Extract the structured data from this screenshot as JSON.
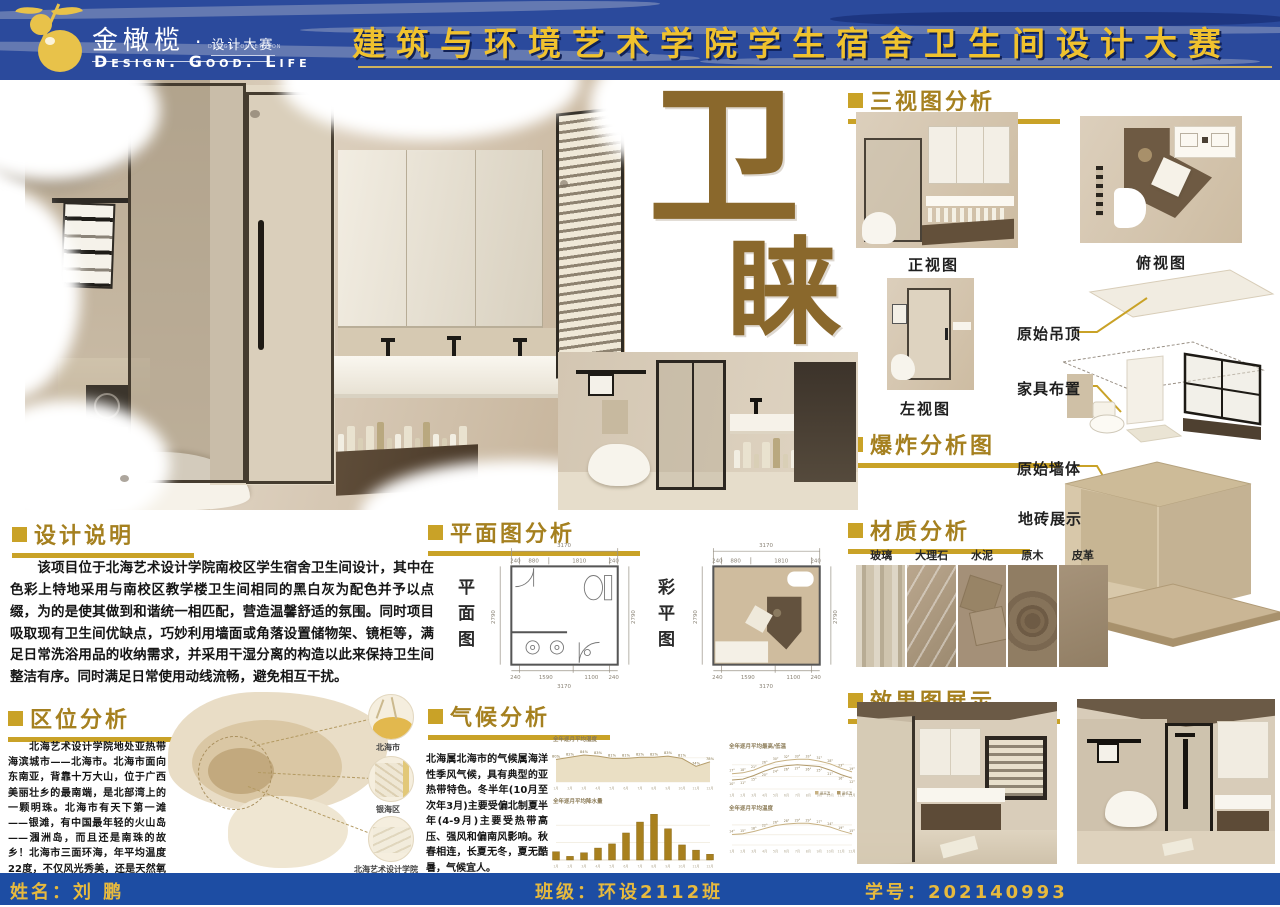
{
  "banner": {
    "brand": "金橄榄",
    "brand_dot": "·",
    "brand_sub": "设计大赛",
    "brand_sub_en": "DESIGN COMPETITION",
    "tagline": "Design. Good. Life",
    "title": "建筑与环境艺术学院学生宿舍卫生间设计大赛"
  },
  "hero": {
    "big_char_top": "卫",
    "big_char_bottom": "睐"
  },
  "three_view": {
    "title": "三视图分析",
    "front_label": "正视图",
    "top_label": "俯视图",
    "left_label": "左视图"
  },
  "explosion": {
    "title": "爆炸分析图",
    "labels": {
      "ceiling": "原始吊顶",
      "furniture": "家具布置",
      "walls": "原始墙体",
      "tiles": "地砖展示"
    }
  },
  "materials": {
    "title": "材质分析",
    "items": [
      "玻璃",
      "大理石",
      "水泥",
      "原木",
      "皮革"
    ]
  },
  "renders": {
    "title": "效果图展示"
  },
  "design_note": {
    "title": "设计说明",
    "body": "　　该项目位于北海艺术设计学院南校区学生宿舍卫生间设计，其中在色彩上特地采用与南校区教学楼卫生间相同的黑白灰为配色并予以点缀，为的是使其做到和谐统一相匹配，营造温馨舒适的氛围。同时项目吸取现有卫生间优缺点，巧妙利用墙面或角落设置储物架、镜柜等，满足日常洗浴用品的收纳需求，并采用干湿分离的构造以此来保持卫生间整洁有序。同时满足日常使用动线流畅，避免相互干扰。"
  },
  "location": {
    "title": "区位分析",
    "body": "　　北海艺术设计学院地处亚热带海滨城市——北海市。北海市面向东南亚，背靠十万大山，位于广西美丽壮乡的最南端，是北部湾上的一颗明珠。北海市有天下第一滩——银滩，有中国最年轻的火山岛——涠洲岛，而且还是南珠的故乡！北海市三面环海，年平均温度22度，不仅风光秀美，还是天然氧吧，被评为中国最适合人居的城市！",
    "map_labels": [
      "北海市",
      "银海区",
      "北海艺术设计学院"
    ]
  },
  "plan": {
    "title": "平面图分析",
    "left_label": "平面图",
    "right_label": "彩平图",
    "dims": {
      "total_w": "3170",
      "total_h": "2790",
      "top_segs": [
        "240",
        "880",
        "1810",
        "240"
      ],
      "bottom_segs": [
        "240",
        "1590",
        "1100",
        "240"
      ]
    }
  },
  "climate": {
    "title": "气候分析",
    "body": "北海属北海市的气候属海洋性季风气候，具有典型的亚热带特色。冬半年(10月至次年3月)主要受偏北制夏半年(4-9月)主要受热带高压、强风和偏南风影响。秋春相连，长夏无冬，夏无酷暑，气候宜人。"
  },
  "chart_data": [
    {
      "id": "humidity",
      "type": "area",
      "title": "全年逐月平均湿度",
      "x": [
        "1月",
        "2月",
        "3月",
        "4月",
        "5月",
        "6月",
        "7月",
        "8月",
        "9月",
        "10月",
        "11月",
        "12月"
      ],
      "values": [
        80,
        82,
        84,
        83,
        81,
        81,
        82,
        82,
        83,
        81,
        74,
        78
      ],
      "unit": "%",
      "ylim": [
        60,
        92
      ],
      "xlabel": "",
      "ylabel": "湿度"
    },
    {
      "id": "precip",
      "type": "bar",
      "title": "全年逐月平均降水量",
      "x": [
        "1月",
        "2月",
        "3月",
        "4月",
        "5月",
        "6月",
        "7月",
        "8月",
        "9月",
        "10月",
        "11月",
        "12月"
      ],
      "values": [
        32,
        14,
        28,
        46,
        62,
        104,
        146,
        176,
        120,
        58,
        38,
        22
      ],
      "unit": "mm",
      "ylim": [
        0,
        200
      ],
      "xlabel": "",
      "ylabel": "降水量"
    },
    {
      "id": "hilo",
      "type": "line",
      "title": "全年逐月平均最高/低温",
      "x": [
        "1月",
        "2月",
        "3月",
        "4月",
        "5月",
        "6月",
        "7月",
        "8月",
        "9月",
        "10月",
        "11月",
        "12月"
      ],
      "series": [
        {
          "name": "最高温",
          "values": [
            17,
            18,
            21,
            26,
            30,
            32,
            33,
            33,
            31,
            28,
            23,
            19
          ]
        },
        {
          "name": "最低温",
          "values": [
            10,
            11,
            15,
            20,
            24,
            26,
            27,
            26,
            25,
            21,
            16,
            12
          ]
        }
      ],
      "unit": "°",
      "ylim": [
        0,
        40
      ],
      "legend_position": "bottom-right"
    },
    {
      "id": "avgtemp",
      "type": "line",
      "title": "全年逐月平均温度",
      "x": [
        "1月",
        "2月",
        "3月",
        "4月",
        "5月",
        "6月",
        "7月",
        "8月",
        "9月",
        "10月",
        "11月",
        "12月"
      ],
      "series": [
        {
          "name": "平均温度",
          "values": [
            14,
            15,
            18,
            22,
            26,
            28,
            29,
            29,
            27,
            24,
            19,
            15
          ]
        }
      ],
      "unit": "°",
      "ylim": [
        0,
        40
      ],
      "legend_position": "none"
    }
  ],
  "footer": {
    "name": "姓名：刘 鹏",
    "class": "班级：环设2112班",
    "student_id": "学号：202140993"
  }
}
